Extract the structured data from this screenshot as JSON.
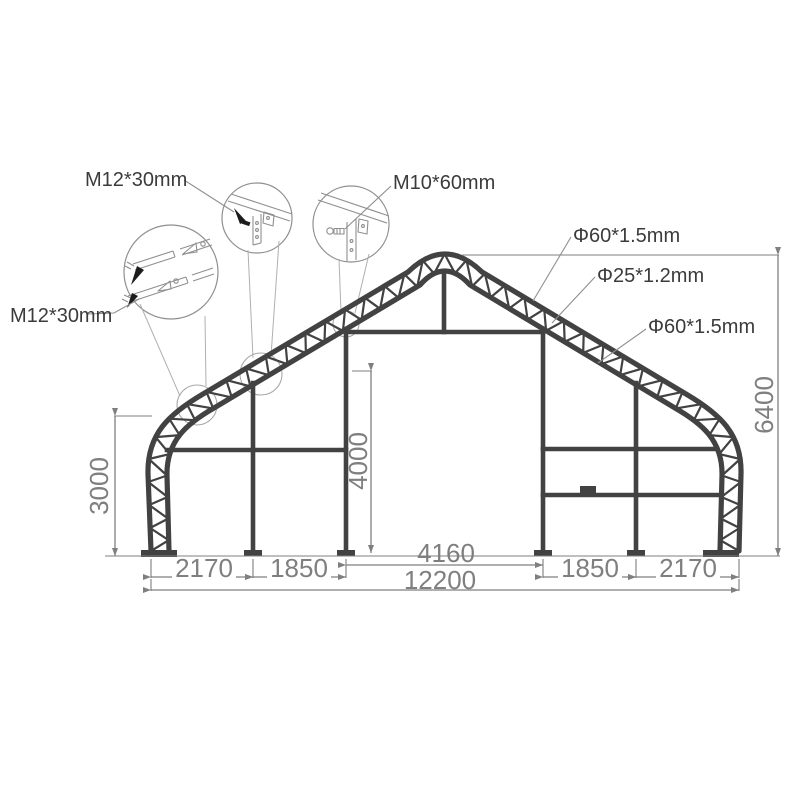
{
  "drawing": {
    "title": "storage-shelter-frame-dimension-drawing",
    "dims": {
      "seg_left_outer": "2170",
      "seg_left_inner": "1850",
      "door_width": "4160",
      "seg_right_inner": "1850",
      "seg_right_outer": "2170",
      "total_width": "12200",
      "side_height": "3000",
      "door_height": "4000",
      "ridge_height": "6400"
    },
    "callouts": {
      "bolt_top": "M12*30mm",
      "bolt_left": "M12*30mm",
      "bolt_door": "M10*60mm",
      "tube_outer": "Φ60*1.5mm",
      "tube_brace": "Φ25*1.2mm",
      "tube_inner": "Φ60*1.5mm"
    },
    "colors": {
      "frame": "#424242",
      "dimension": "#7f7f7f",
      "callout_text": "#3b3b3b",
      "detail_lines": "#8f8f8f",
      "background": "#ffffff"
    }
  }
}
